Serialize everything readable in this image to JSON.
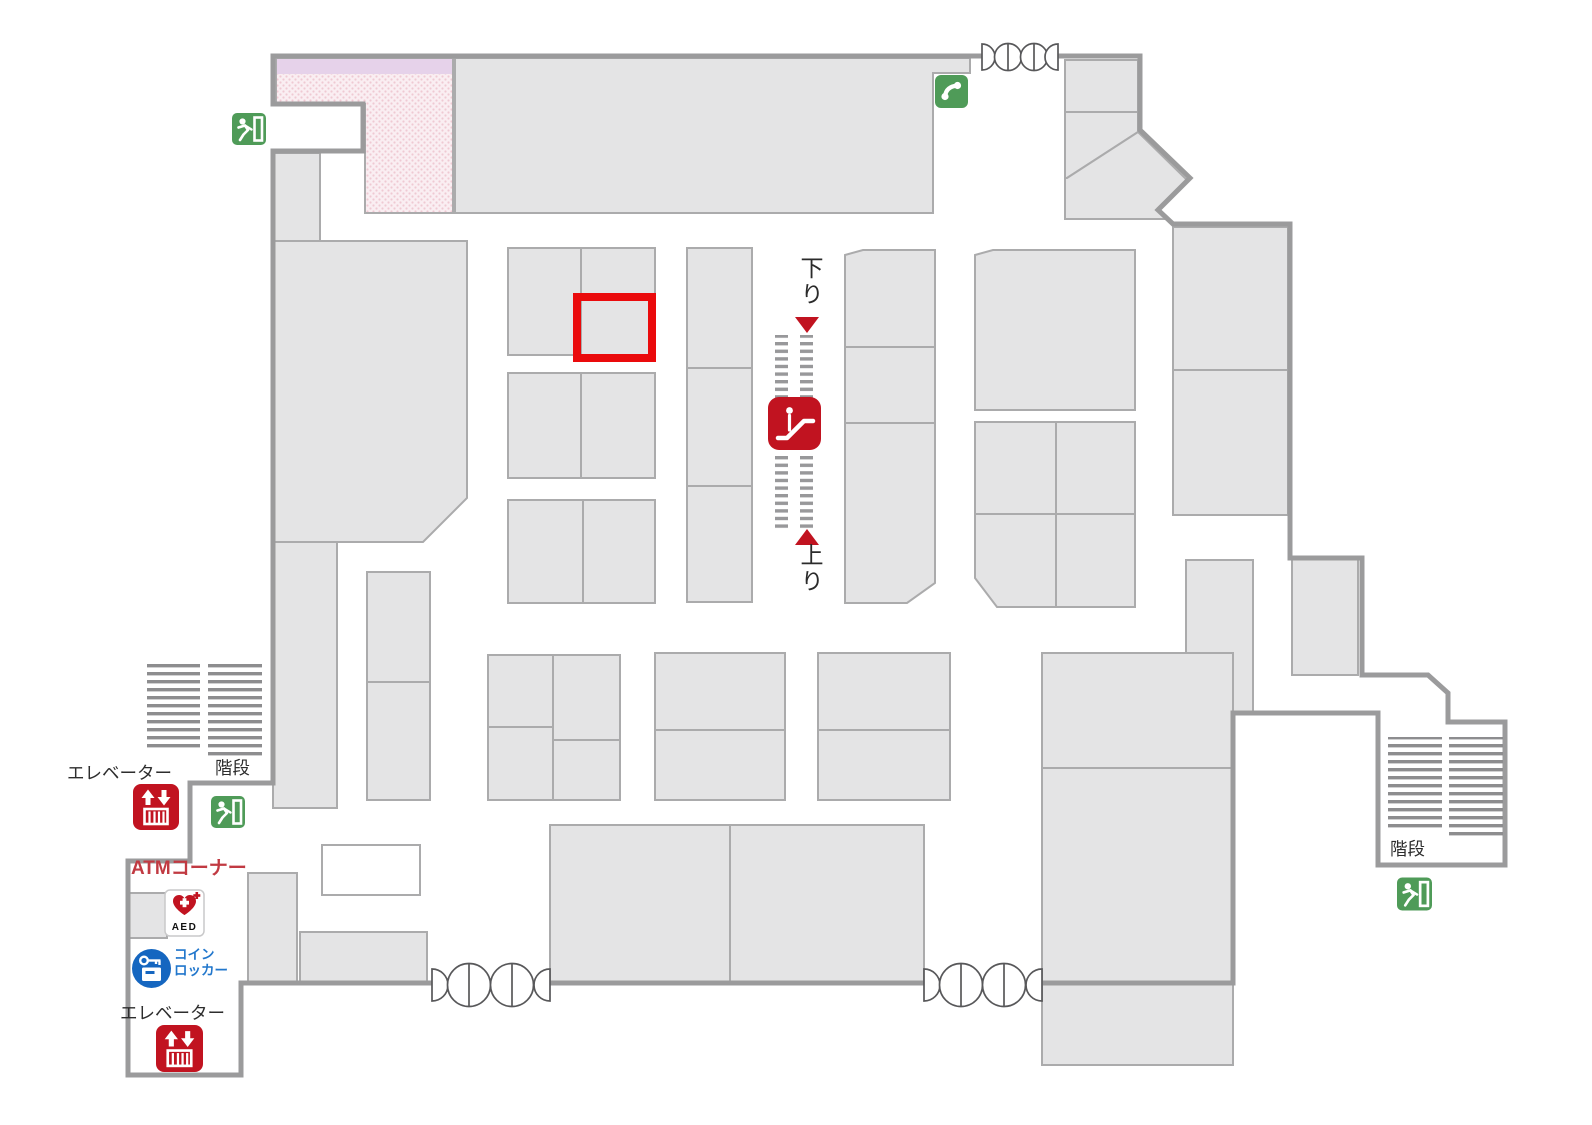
{
  "map": {
    "title": "mall-floor-plan",
    "labels": {
      "escalator_down": "下り",
      "escalator_up": "上り",
      "elevator_upper": "エレベーター",
      "elevator_lower": "エレベーター",
      "stairs_left": "階段",
      "stairs_right": "階段",
      "atm_corner": "ATMコーナー",
      "aed": "AED",
      "coin_locker_line1": "コイン",
      "coin_locker_line2": "ロッカー"
    },
    "icons": {
      "escalator": "escalator-icon",
      "elevator_upper": "elevator-icon",
      "elevator_lower": "elevator-icon",
      "exit_top_left": "emergency-exit-icon",
      "exit_mid_left": "emergency-exit-icon",
      "exit_bottom_right": "emergency-exit-icon",
      "phone": "public-phone-icon",
      "aed": "aed-icon",
      "coin_locker": "coin-locker-icon",
      "door_top": "revolving-door-symbol",
      "door_bottom_left": "revolving-door-symbol",
      "door_bottom_right": "revolving-door-symbol"
    },
    "highlight": {
      "x": 577,
      "y": 297,
      "width": 75,
      "height": 61
    },
    "colors": {
      "wall": "#9b9b9c",
      "block": "#e4e4e5",
      "block-stroke": "#ababac",
      "red": "#c11320",
      "green": "#4f9b58",
      "blue": "#1566c0",
      "blue-text": "#2277cc",
      "atm-red": "#c13a42",
      "pink-base": "#faeef2",
      "pink-dot": "#efc9d3",
      "lavender": "#e6d2ea",
      "stripe": "#98989a",
      "stairs-bar": "#8d8d8f",
      "highlight": "#ea0a0c",
      "label": "#2d2d2d",
      "door-stroke": "#58585a"
    }
  }
}
